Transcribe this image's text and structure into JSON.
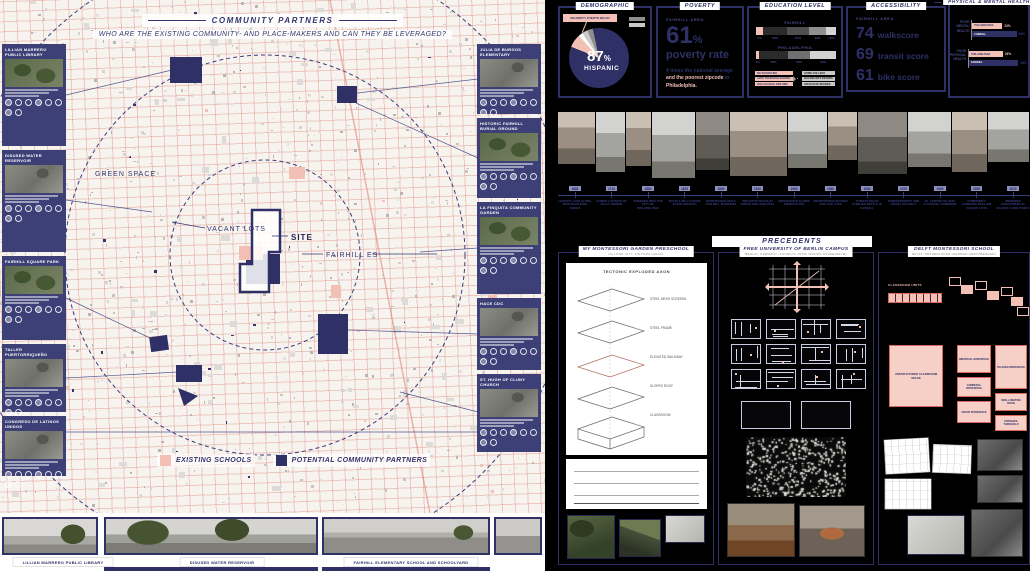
{
  "colors": {
    "navy": "#2e3066",
    "pink": "#f3c0b5",
    "map_bg": "#f7f4f0",
    "board_bg": "#000000"
  },
  "map_panel": {
    "title": "COMMUNITY PARTNERS",
    "question": "WHO ARE THE EXISTING COMMUNITY- AND PLACE-MAKERS AND CAN THEY BE LEVERAGED?",
    "labels": {
      "green_space": "GREEN SPACE",
      "vacant_lots": "VACANT LOTS",
      "site": "SITE",
      "fairhill_es": "FAIRHILL ES"
    },
    "legend": [
      {
        "label": "EXISTING SCHOOLS",
        "color": "#f3c0b5"
      },
      {
        "label": "POTENTIAL COMMUNITY PARTNERS",
        "color": "#2e3066"
      }
    ],
    "partner_cards_left": [
      {
        "title": "LILLIAN MARRERO PUBLIC LIBRARY",
        "tone": "green"
      },
      {
        "title": "DISUSED WATER RESERVOIR",
        "tone": "gray"
      },
      {
        "title": "FAIRHILL SQUARE PARK",
        "tone": "green"
      },
      {
        "title": "TALLER PUERTORRIQUEÑO",
        "tone": "gray"
      },
      {
        "title": "CONGRESO DE LATINOS UNIDOS",
        "tone": "gray"
      }
    ],
    "partner_cards_right": [
      {
        "title": "JULIA DE BURGOS ELEMENTARY",
        "tone": "gray"
      },
      {
        "title": "HISTORIC FAIRHILL BURIAL GROUND",
        "tone": "green"
      },
      {
        "title": "LA FINQUITA COMMUNITY GARDEN",
        "tone": "green"
      },
      {
        "title": "HACE CDC",
        "tone": "gray"
      },
      {
        "title": "ST. HUGH OF CLUNY CHURCH",
        "tone": "gray"
      }
    ],
    "photo_captions": [
      "LILLIAN MARRERO PUBLIC LIBRARY",
      "DISUSED WATER RESERVOIR",
      "FAIRHILL ELEMENTARY SCHOOL AND SCHOOLYARD"
    ]
  },
  "stats": {
    "demographic": {
      "title": "DEMOGRAPHIC",
      "value": "87",
      "unit": "%",
      "label": "HISPANIC",
      "callout": "MAJORITY PUERTO RICAN",
      "pie": {
        "hispanic_pct": 87,
        "other_pct": 13
      }
    },
    "poverty": {
      "title": "POVERTY",
      "area": "FAIRHILL AREA",
      "value": "61",
      "unit": "%",
      "label": "poverty rate",
      "note_parts": [
        {
          "text": "4 times the national average ",
          "highlight": false
        },
        {
          "text": "and the poorest zipcode",
          "highlight": true
        },
        {
          "text": " in ",
          "highlight": false
        },
        {
          "text": "Philadelphia.",
          "highlight": true
        }
      ]
    },
    "education": {
      "title": "EDUCATION LEVEL",
      "bars": [
        {
          "label": "FAIRHILL",
          "segments": [
            {
              "pct": 9,
              "color": "#f3c0b5",
              "tick": "9%"
            },
            {
              "pct": 30,
              "color": "#2b2b2b",
              "tick": "30%"
            },
            {
              "pct": 27,
              "color": "#4f4f4f",
              "tick": "27%"
            },
            {
              "pct": 22,
              "color": "#8f8f8f",
              "tick": "22%"
            },
            {
              "pct": 12,
              "color": "#d2d2d2",
              "tick": "12%"
            }
          ]
        },
        {
          "label": "PHILADELPHIA",
          "segments": [
            {
              "pct": 4,
              "color": "#f3c0b5",
              "tick": "4%"
            },
            {
              "pct": 36,
              "color": "#2b2b2b",
              "tick": "36%"
            },
            {
              "pct": 28,
              "color": "#707070",
              "tick": "28%"
            },
            {
              "pct": 32,
              "color": "#d2d2d2",
              "tick": "32%"
            }
          ]
        }
      ],
      "legend_left": [
        "NO SCHOOLING",
        "LESS THAN HIGH SCHOOL",
        "HIGH SCHOOL DIPLOMA"
      ],
      "legend_right": [
        "SOME COLLEGE",
        "BACHELOR'S DEGREE",
        "GRADUATE DEGREE"
      ]
    },
    "accessibility": {
      "title": "ACCESSIBILITY",
      "area": "FAIRHILL AREA",
      "scores": [
        {
          "value": "74",
          "label": "walkscore"
        },
        {
          "value": "69",
          "label": "transit score"
        },
        {
          "value": "61",
          "label": "bike score"
        }
      ]
    },
    "health": {
      "title": "PHYSICAL & MENTAL HEALTH",
      "groups": [
        {
          "label": "POOR MENTAL HEALTH",
          "bars": [
            {
              "name": "PHILADELPHIA",
              "pct": 23,
              "tick": "23%",
              "type": "pink"
            },
            {
              "name": "FAIRHILL",
              "pct": 34,
              "tick": "34%",
              "type": "navy"
            }
          ]
        },
        {
          "label": "POOR PHYSICAL HEALTH",
          "bars": [
            {
              "name": "PHILADELPHIA",
              "pct": 26,
              "tick": "26%",
              "type": "pink"
            },
            {
              "name": "FAIRHILL",
              "pct": 38,
              "tick": "38%",
              "type": "navy"
            }
          ]
        }
      ]
    }
  },
  "timeline": {
    "entries": [
      {
        "year": "1681",
        "caption": "LENAPE LAND ALONG WINGOHOCKING CREEK"
      },
      {
        "year": "1718",
        "caption": "FAIRHILL ESTATE OF ISAAC NORRIS"
      },
      {
        "year": "1854",
        "caption": "ANNEXED INTO THE CITY OF PHILADELPHIA"
      },
      {
        "year": "1876",
        "caption": "TEXTILE MILLS DRIVE RAPID GROWTH"
      },
      {
        "year": "1890",
        "caption": "ROWHOUSES BUILT FOR MILL WORKERS"
      },
      {
        "year": "1910",
        "caption": "INDUSTRY PEAKS IN NORTH PHILADELPHIA"
      },
      {
        "year": "1930",
        "caption": "DEPRESSION SLOWS PRODUCTION"
      },
      {
        "year": "1950",
        "caption": "DEINDUSTRIALIZATION AND JOB LOSS"
      },
      {
        "year": "1965",
        "caption": "PUERTO RICAN FAMILIES SETTLE IN FAIRHILL"
      },
      {
        "year": "1975",
        "caption": "DISINVESTMENT AND RISING VACANCY"
      },
      {
        "year": "1990",
        "caption": "EL CENTRO DE ORO CULTURAL CORRIDOR"
      },
      {
        "year": "2005",
        "caption": "COMMUNITY GARDENS RECLAIM VACANT LOTS"
      },
      {
        "year": "2015",
        "caption": "RENEWED INVESTMENT IN SCHOOLS AND PARKS"
      }
    ]
  },
  "precedents": {
    "title": "PRECEDENTS",
    "panels": [
      {
        "name": "MY MONTESSORI GARDEN PRESCHOOL",
        "location": "HA LONG CITY, VIETNAM (HGAA)",
        "diagram_title": "TECTONIC EXPLODED AXON",
        "layers": [
          "STEEL MESH SCREENS",
          "STEEL FRAME",
          "ELEVATED WALKWAY",
          "SLOPED ROOF",
          "CLASSROOM"
        ]
      },
      {
        "name": "FREE UNIVERSITY OF BERLIN CAMPUS",
        "location": "BERLIN, GERMANY (CANDILIS JOSIC WOODS SCHIEDHELM)"
      },
      {
        "name": "DELFT MONTESSORI SCHOOL",
        "location": "DELFT, NETHERLANDS (HERMAN HERTZBERGER)",
        "diagram_labels": [
          "CLASSROOM UNITS",
          "UNSTRUCTURED CLASSROOM SPACE",
          "INDIVIDUAL WORKSPACE",
          "TEACHER WORKSPACE",
          "COMMUNAL WORKSPACE",
          "SMALL MEETING SPACE",
          "GROUP WORKSPACE",
          "ENTRANCE THRESHOLD"
        ]
      }
    ]
  }
}
